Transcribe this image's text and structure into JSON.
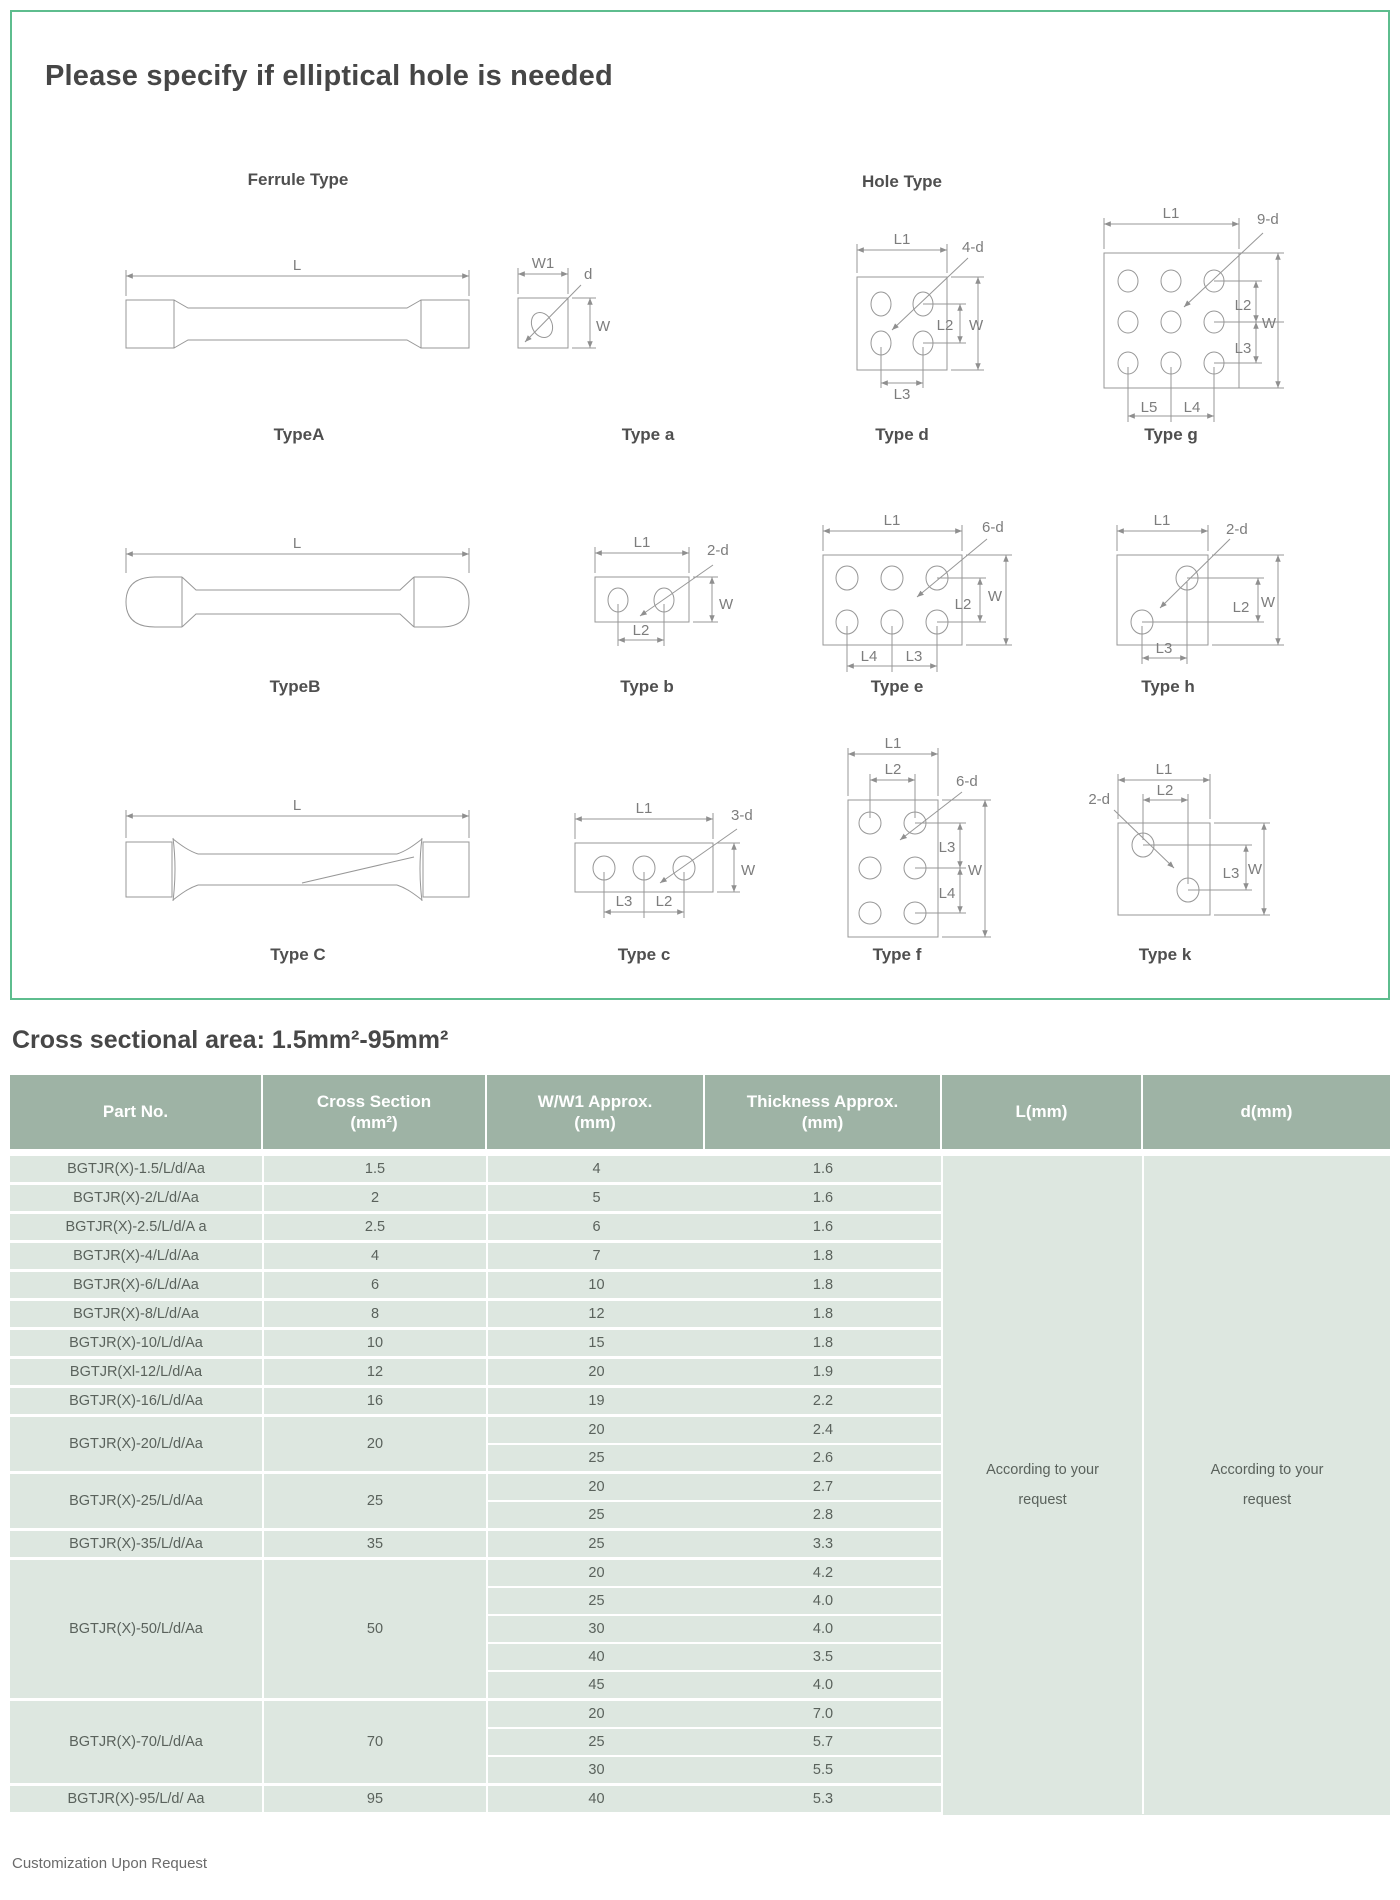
{
  "page": {
    "title": "Please specify if elliptical hole is needed",
    "section_heading": "Cross sectional area: 1.5mm²-95mm²",
    "footer": "Customization Upon Request"
  },
  "diagram_panel": {
    "ferrule_header": "Ferrule Type",
    "hole_header": "Hole Type",
    "ferrule_a": {
      "name": "TypeA",
      "labels": {
        "l": "L"
      }
    },
    "hole_a": {
      "name": "Type a",
      "labels": {
        "w1": "W1",
        "d": "d",
        "w": "W"
      }
    },
    "hole_d": {
      "name": "Type d",
      "labels": {
        "l1": "L1",
        "nd": "4-d",
        "l2": "L2",
        "w": "W",
        "l3": "L3"
      }
    },
    "hole_g": {
      "name": "Type g",
      "labels": {
        "l1": "L1",
        "nd": "9-d",
        "l2": "L2",
        "l3": "L3",
        "w": "W",
        "l5": "L5",
        "l4": "L4"
      }
    },
    "ferrule_b": {
      "name": "TypeB",
      "labels": {
        "l": "L"
      }
    },
    "hole_b": {
      "name": "Type b",
      "labels": {
        "l1": "L1",
        "nd": "2-d",
        "w": "W",
        "l2": "L2"
      }
    },
    "hole_e": {
      "name": "Type e",
      "labels": {
        "l1": "L1",
        "nd": "6-d",
        "l2": "L2",
        "w": "W",
        "l4": "L4",
        "l3": "L3"
      }
    },
    "hole_h": {
      "name": "Type h",
      "labels": {
        "l1": "L1",
        "nd": "2-d",
        "l2": "L2",
        "w": "W",
        "l3": "L3"
      }
    },
    "ferrule_c": {
      "name": "Type C",
      "labels": {
        "l": "L"
      }
    },
    "hole_c": {
      "name": "Type c",
      "labels": {
        "l1": "L1",
        "nd": "3-d",
        "w": "W",
        "l3": "L3",
        "l2": "L2"
      }
    },
    "hole_f": {
      "name": "Type f",
      "labels": {
        "l1": "L1",
        "l2": "L2",
        "nd": "6-d",
        "l3": "L3",
        "l4": "L4",
        "w": "W"
      }
    },
    "hole_k": {
      "name": "Type k",
      "labels": {
        "nd": "2-d",
        "l1": "L1",
        "l2": "L2",
        "l3": "L3",
        "w": "W"
      }
    }
  },
  "table": {
    "columns": [
      {
        "line1": "Part No.",
        "line2": ""
      },
      {
        "line1": "Cross Section",
        "line2": "(mm²)"
      },
      {
        "line1": "W/W1 Approx.",
        "line2": "(mm)"
      },
      {
        "line1": "Thickness Approx.",
        "line2": "(mm)"
      },
      {
        "line1": "L(mm)",
        "line2": ""
      },
      {
        "line1": "d(mm)",
        "line2": ""
      }
    ],
    "groups": [
      {
        "part": "BGTJR(X)-1.5/L/d/Aa",
        "cross": "1.5",
        "rows": [
          [
            "4",
            "1.6"
          ]
        ]
      },
      {
        "part": "BGTJR(X)-2/L/d/Aa",
        "cross": "2",
        "rows": [
          [
            "5",
            "1.6"
          ]
        ]
      },
      {
        "part": "BGTJR(X)-2.5/L/d/A a",
        "cross": "2.5",
        "rows": [
          [
            "6",
            "1.6"
          ]
        ]
      },
      {
        "part": "BGTJR(X)-4/L/d/Aa",
        "cross": "4",
        "rows": [
          [
            "7",
            "1.8"
          ]
        ]
      },
      {
        "part": "BGTJR(X)-6/L/d/Aa",
        "cross": "6",
        "rows": [
          [
            "10",
            "1.8"
          ]
        ]
      },
      {
        "part": "BGTJR(X)-8/L/d/Aa",
        "cross": "8",
        "rows": [
          [
            "12",
            "1.8"
          ]
        ]
      },
      {
        "part": "BGTJR(X)-10/L/d/Aa",
        "cross": "10",
        "rows": [
          [
            "15",
            "1.8"
          ]
        ]
      },
      {
        "part": "BGTJR(Xl-12/L/d/Aa",
        "cross": "12",
        "rows": [
          [
            "20",
            "1.9"
          ]
        ]
      },
      {
        "part": "BGTJR(X)-16/L/d/Aa",
        "cross": "16",
        "rows": [
          [
            "19",
            "2.2"
          ]
        ]
      },
      {
        "part": "BGTJR(X)-20/L/d/Aa",
        "cross": "20",
        "rows": [
          [
            "20",
            "2.4"
          ],
          [
            "25",
            "2.6"
          ]
        ]
      },
      {
        "part": "BGTJR(X)-25/L/d/Aa",
        "cross": "25",
        "rows": [
          [
            "20",
            "2.7"
          ],
          [
            "25",
            "2.8"
          ]
        ]
      },
      {
        "part": "BGTJR(X)-35/L/d/Aa",
        "cross": "35",
        "rows": [
          [
            "25",
            "3.3"
          ]
        ]
      },
      {
        "part": "BGTJR(X)-50/L/d/Aa",
        "cross": "50",
        "rows": [
          [
            "20",
            "4.2"
          ],
          [
            "25",
            "4.0"
          ],
          [
            "30",
            "4.0"
          ],
          [
            "40",
            "3.5"
          ],
          [
            "45",
            "4.0"
          ]
        ]
      },
      {
        "part": "BGTJR(X)-70/L/d/Aa",
        "cross": "70",
        "rows": [
          [
            "20",
            "7.0"
          ],
          [
            "25",
            "5.7"
          ],
          [
            "30",
            "5.5"
          ]
        ]
      },
      {
        "part": "BGTJR(X)-95/L/d/ Aa",
        "cross": "95",
        "rows": [
          [
            "40",
            "5.3"
          ]
        ]
      }
    ],
    "l_note_lines": [
      "According to your",
      "request"
    ],
    "d_note_lines": [
      "According to your",
      "request"
    ]
  }
}
